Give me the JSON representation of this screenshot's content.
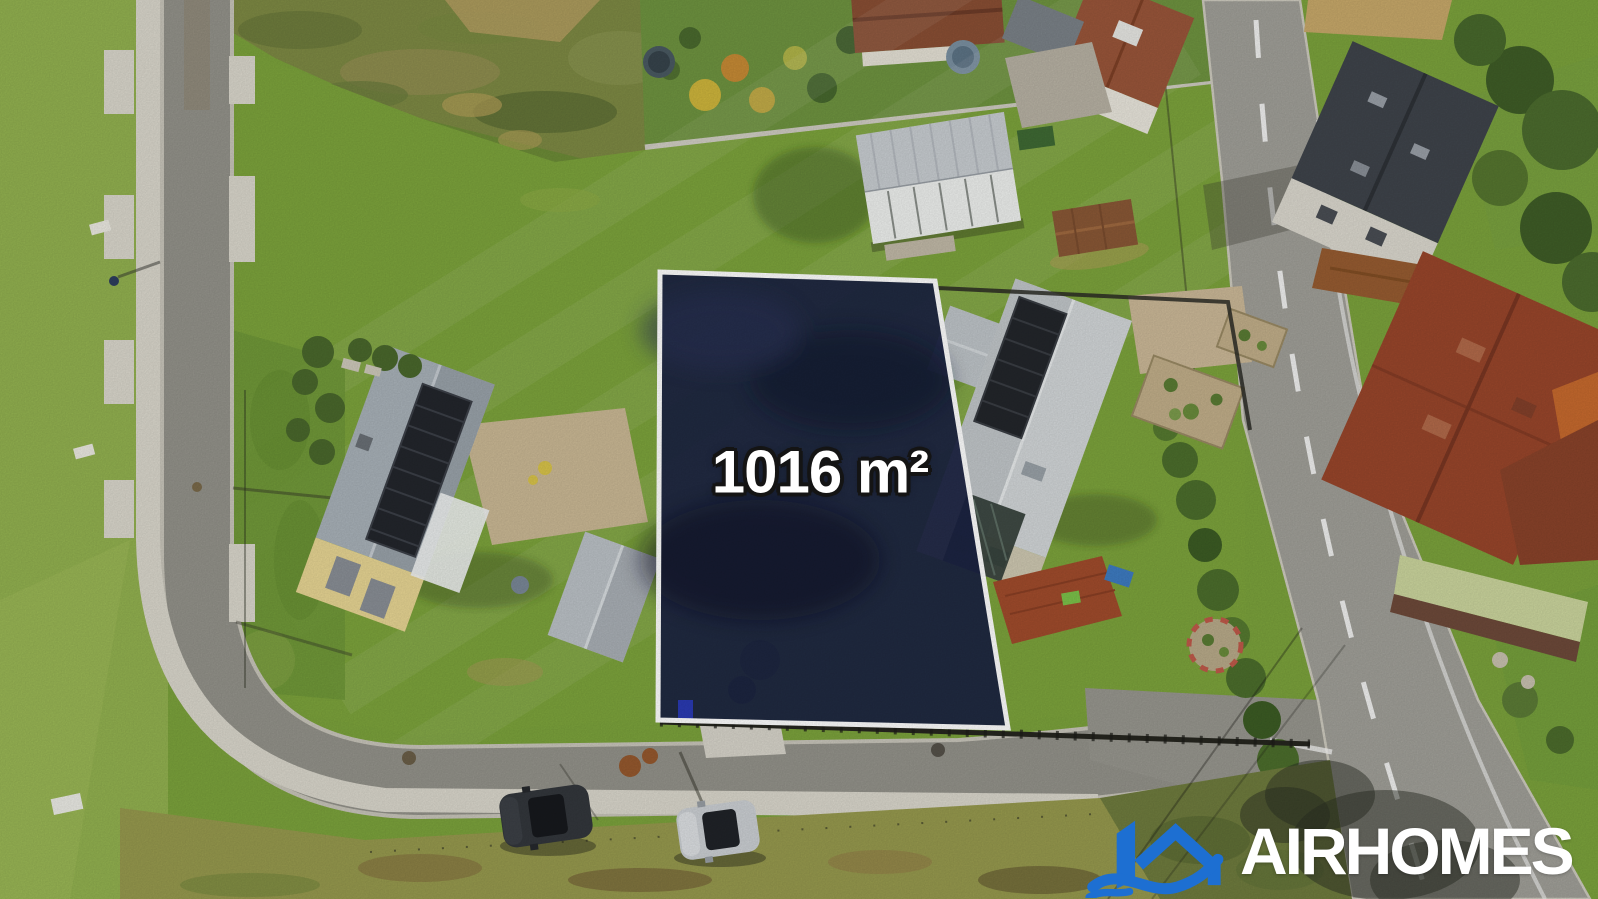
{
  "overlay": {
    "plot_area_label": "1016 m²",
    "brand_name": "AIRHOMES"
  },
  "plot": {
    "area_value": "1016",
    "area_unit": "m²",
    "fill_color": "#1b2242",
    "border_color": "#ffffff"
  },
  "logo": {
    "icon": "house-with-wave-icon",
    "icon_color": "#1d6fd2",
    "text_color": "#ffffff"
  },
  "scene": {
    "type": "aerial-drone-photo",
    "elements": [
      "highlighted-plot-polygon",
      "left-street-with-sidewalk",
      "bottom-street",
      "main-road",
      "mowed-field",
      "rough-brush",
      "yellow-house-with-solar-roof",
      "gray-house-with-solar-roof",
      "white-tent-building",
      "garden-sheds",
      "red-roof-houses",
      "slate-roof-house",
      "hedges-and-trees",
      "parked-car-dark",
      "parked-car-silver",
      "pedestrian"
    ]
  }
}
